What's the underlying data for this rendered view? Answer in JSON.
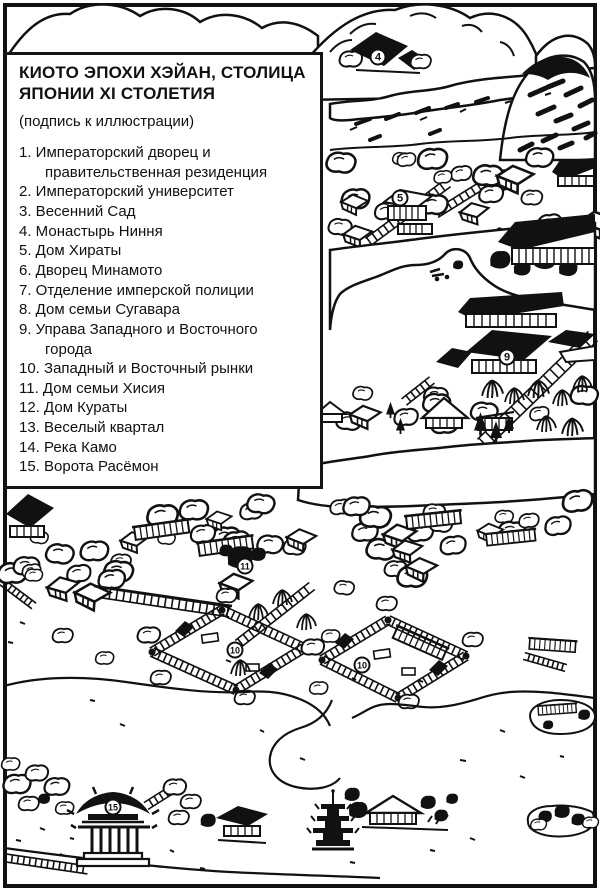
{
  "legend": {
    "title_line1": "КИОТО ЭПОХИ ХЭЙАН, СТОЛИЦА",
    "title_line2": "ЯПОНИИ XI СТОЛЕТИЯ",
    "caption": "(подпись к иллюстрации)",
    "items": [
      {
        "number": "1.",
        "label": "Императорский дворец и правительственная резиденция"
      },
      {
        "number": "2.",
        "label": "Императорский университет"
      },
      {
        "number": "3.",
        "label": "Весенний Сад"
      },
      {
        "number": "4.",
        "label": "Монастырь Ниння"
      },
      {
        "number": "5.",
        "label": "Дом Хираты"
      },
      {
        "number": "6.",
        "label": "Дворец Минамото"
      },
      {
        "number": "7.",
        "label": "Отделение имперской полиции"
      },
      {
        "number": "8.",
        "label": "Дом семьи Сугавара"
      },
      {
        "number": "9.",
        "label": "Управа Западного и Восточного города"
      },
      {
        "number": "10.",
        "label": "Западный и Восточный рынки"
      },
      {
        "number": "11.",
        "label": "Дом семьи Хисия"
      },
      {
        "number": "12.",
        "label": "Дом Кураты"
      },
      {
        "number": "13.",
        "label": "Веселый квартал"
      },
      {
        "number": "14.",
        "label": "Река Камо"
      },
      {
        "number": "15.",
        "label": "Ворота Расёмон"
      }
    ]
  },
  "map": {
    "ink_color": "#111111",
    "paper_color": "#ffffff",
    "markers": [
      {
        "id": "marker-4",
        "number": "4",
        "x": 378,
        "y": 57,
        "label": "Монастырь Ниння"
      },
      {
        "id": "marker-5",
        "number": "5",
        "x": 400,
        "y": 198,
        "label": "Дом Хираты"
      },
      {
        "id": "marker-9",
        "number": "9",
        "x": 507,
        "y": 357,
        "label": "Управа Западного и Восточного города"
      },
      {
        "id": "marker-11",
        "number": "11",
        "x": 245,
        "y": 566,
        "label": "Дом семьи Хисия"
      },
      {
        "id": "marker-10-west",
        "number": "10",
        "x": 235,
        "y": 650,
        "label": "Западный и Восточный рынки"
      },
      {
        "id": "marker-10-east",
        "number": "10",
        "x": 362,
        "y": 665,
        "label": "Западный и Восточный рынки"
      },
      {
        "id": "marker-15",
        "number": "15",
        "x": 113,
        "y": 807,
        "label": "Ворота Расёмон"
      }
    ]
  }
}
